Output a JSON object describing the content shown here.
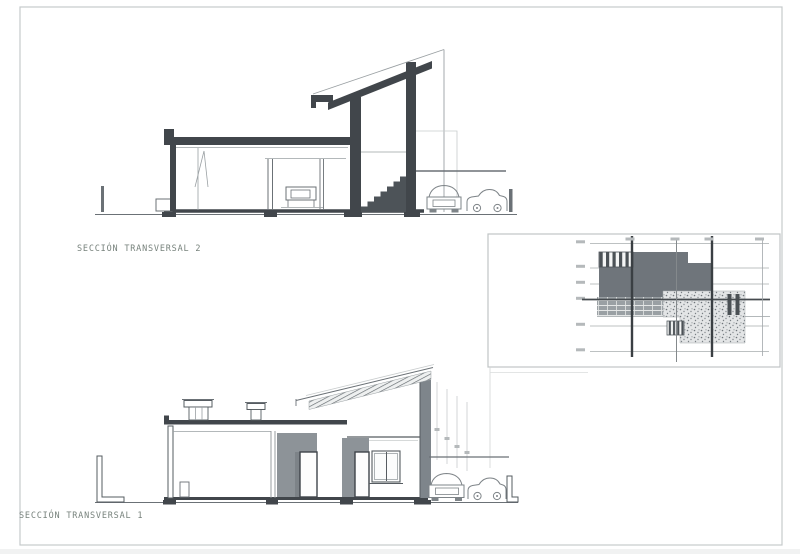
{
  "labels": {
    "section_top": "SECCIÓN TRANSVERSAL 2",
    "section_bottom": "SECCIÓN TRANSVERSAL 1"
  },
  "colors": {
    "paper": "#ffffff",
    "frame": "#c6cacc",
    "ink_dark": "#41464b",
    "ink_medium": "#6b7176",
    "ink_light": "#9aa0a3",
    "ink_faint": "#c8cccd",
    "wall_shade": "#8d9398",
    "slab_fill": "#6f757b",
    "label_text": "#77827c"
  }
}
